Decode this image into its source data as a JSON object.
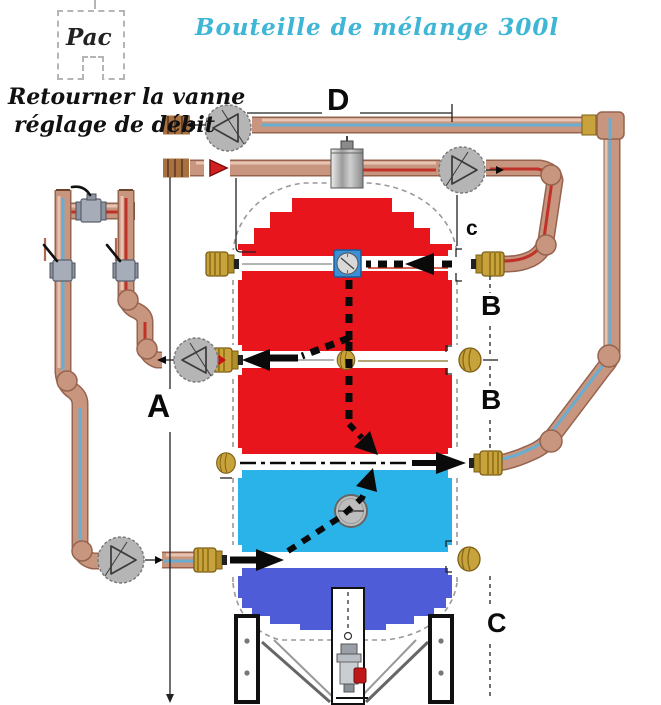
{
  "title": "Bouteille de mélange 300l",
  "pac": {
    "label": "Pac"
  },
  "note": {
    "line1": "Retourner la vanne",
    "line2": "réglage de débit"
  },
  "dimensions": {
    "top_run": "D",
    "tank_height": "A",
    "port_spacing_upper": "B",
    "port_spacing_lower": "B",
    "pump_drop": "c",
    "base_height": "C"
  },
  "colors": {
    "title": "#3fb6d6",
    "tank_hot": "#e8151c",
    "tank_warm": "#2ab3e8",
    "tank_cold": "#4f5cd8",
    "copper": "#c8957f",
    "copper_dark": "#96644e",
    "copper_light": "#ecccba",
    "stripe_cold": "#68aed2",
    "stripe_hot": "#c03228",
    "brass": "#c8a33c",
    "brass_dark": "#7c5f14",
    "pump_fill": "#b5b5b5",
    "steel": "#a7adb8",
    "outline": "#999999",
    "check_valve": "#d41f1f",
    "drain_handle": "#c01818",
    "flow": "#0a0a0a"
  },
  "icons": {
    "pump": "circle-with-triangle",
    "ball_valve": "gray-body-black-lever",
    "check_valve": "red-triangle",
    "brass_fitting": "hex-union",
    "brass_plug": "round-plug",
    "thermometer": "blue-square-dial",
    "temperature_gauge": "round-gray-dial",
    "air_vent": "gray-cylinder",
    "drain_valve": "valve-with-red-handle"
  }
}
